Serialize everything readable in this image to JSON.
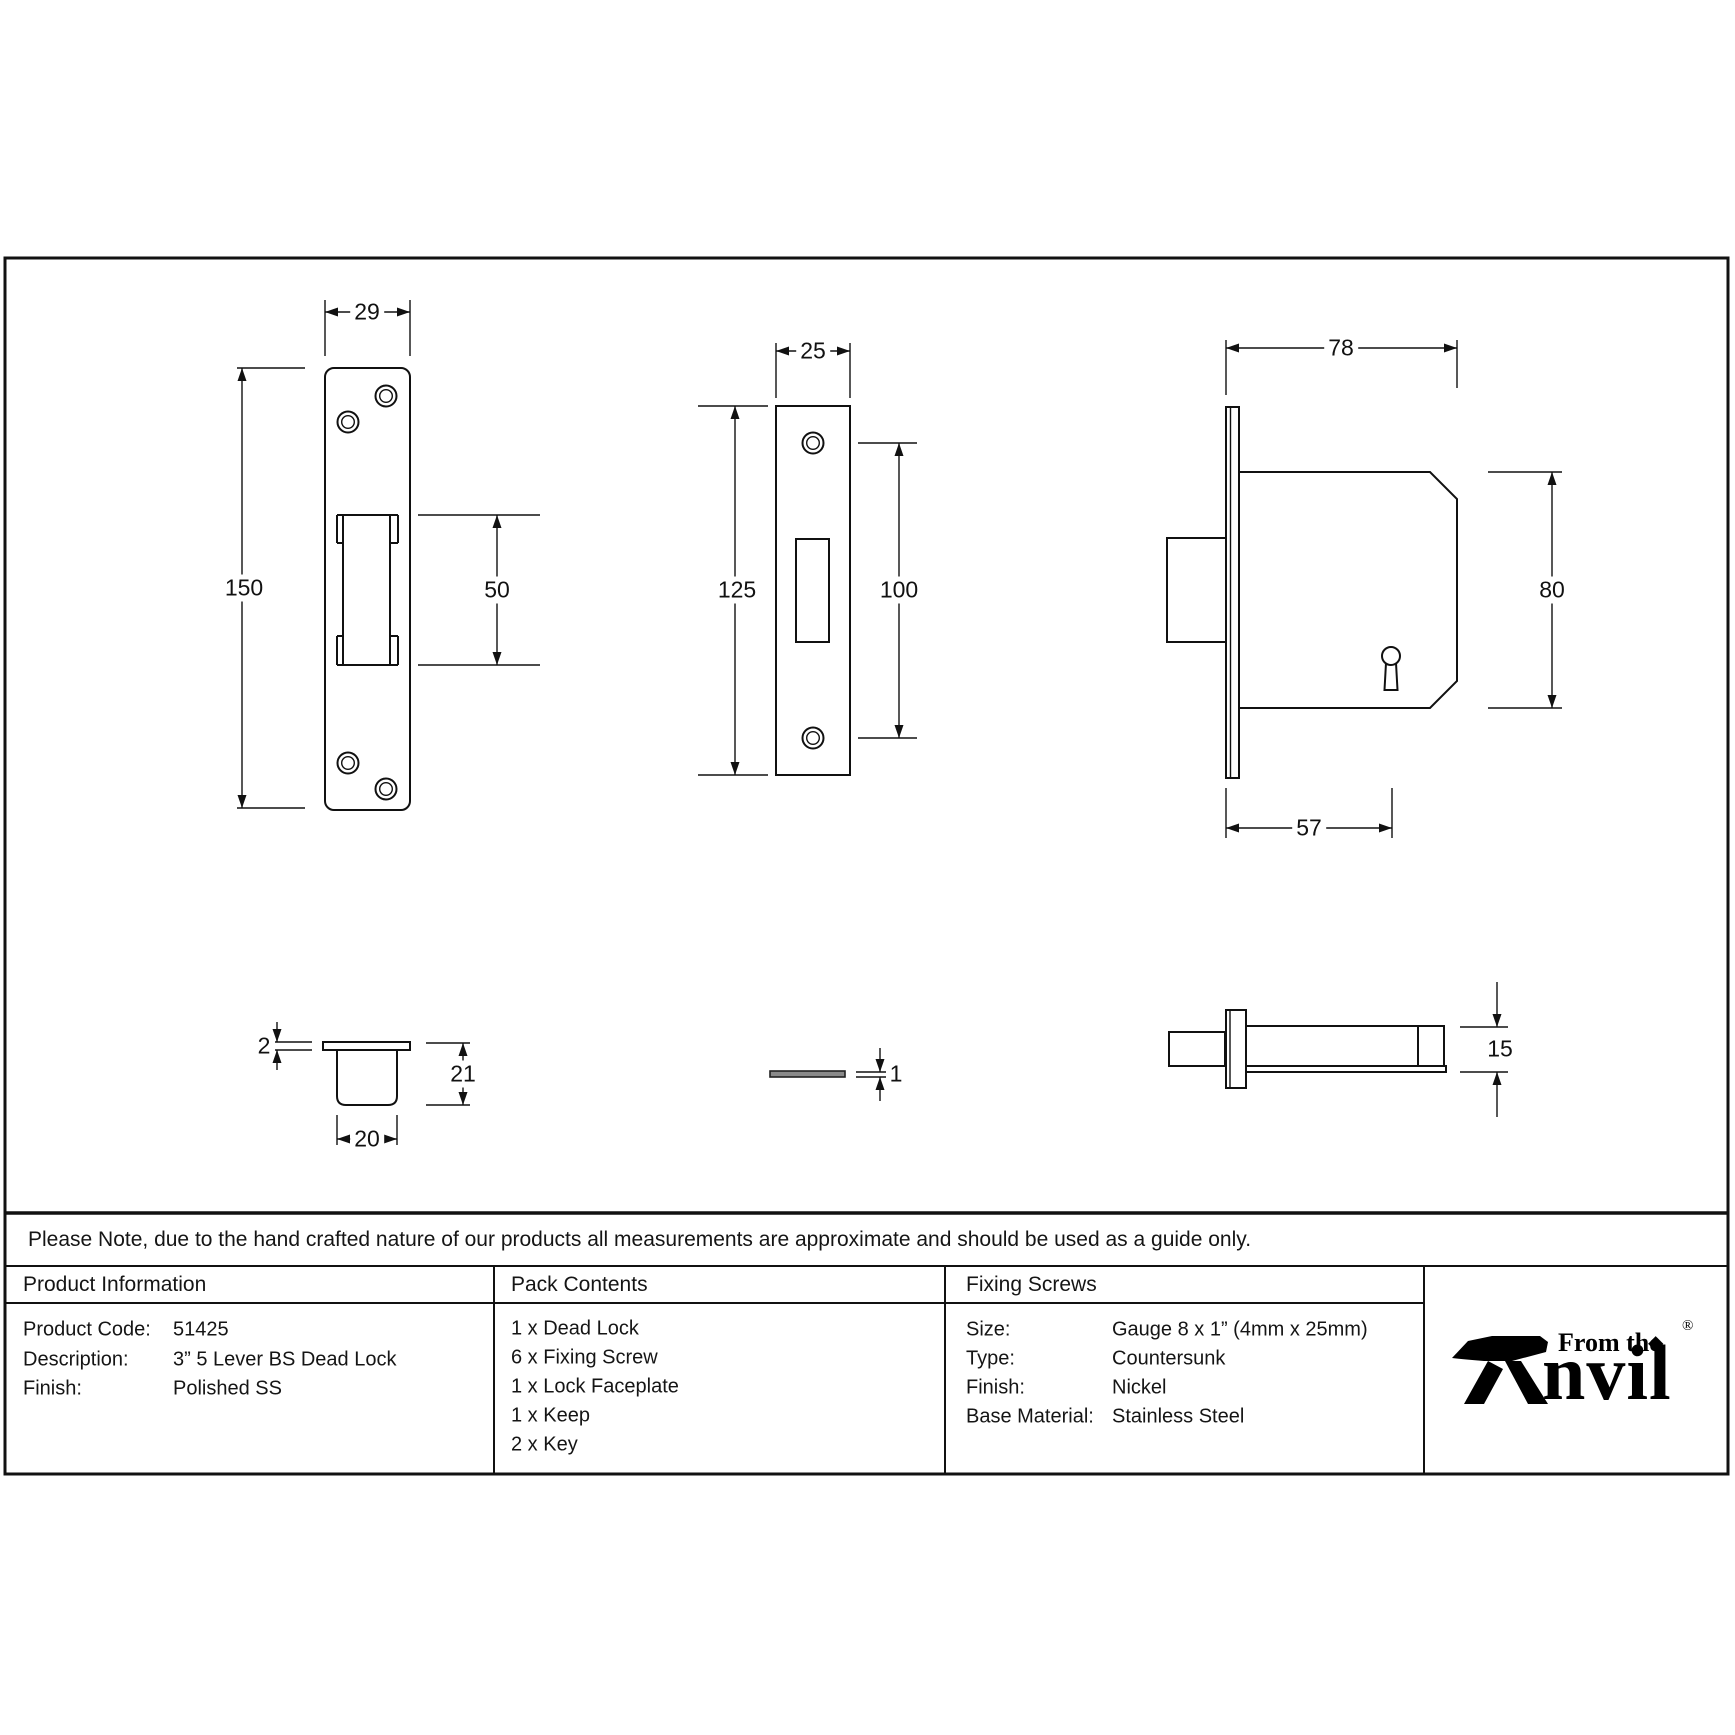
{
  "note": "Please Note, due to the hand crafted nature of our products all measurements are approximate and should be used as a guide only.",
  "colors": {
    "line": "#111111",
    "thin_plate_fill": "#8a8a8a"
  },
  "drawings": {
    "keep_front": {
      "dims": {
        "width": "29",
        "height": "150",
        "slot_height": "50"
      }
    },
    "faceplate_front": {
      "dims": {
        "width": "25",
        "height": "125",
        "hole_spacing": "100"
      }
    },
    "lock_body_side": {
      "dims": {
        "width": "78",
        "height": "80",
        "backset": "57"
      }
    },
    "keep_section": {
      "dims": {
        "flange_thickness": "2",
        "depth": "21",
        "width": "20"
      }
    },
    "faceplate_edge": {
      "dims": {
        "thickness": "1"
      }
    },
    "bolt_side": {
      "dims": {
        "height": "15"
      }
    }
  },
  "table": {
    "product_information": {
      "header": "Product Information",
      "rows": [
        {
          "label": "Product Code:",
          "value": "51425"
        },
        {
          "label": "Description:",
          "value": "3” 5 Lever BS Dead Lock"
        },
        {
          "label": "Finish:",
          "value": "Polished SS"
        }
      ]
    },
    "pack_contents": {
      "header": "Pack Contents",
      "items": [
        "1 x Dead Lock",
        "6 x Fixing Screw",
        "1 x Lock Faceplate",
        "1 x Keep",
        "2 x Key"
      ]
    },
    "fixing_screws": {
      "header": "Fixing Screws",
      "rows": [
        {
          "label": "Size:",
          "value": "Gauge 8 x 1” (4mm x 25mm)"
        },
        {
          "label": "Type:",
          "value": "Countersunk"
        },
        {
          "label": "Finish:",
          "value": "Nickel"
        },
        {
          "label": "Base Material:",
          "value": "Stainless Steel"
        }
      ]
    }
  },
  "logo": {
    "prefix": "From the",
    "brand_suffix": "nvil",
    "diamond": "◆",
    "registered": "®"
  }
}
